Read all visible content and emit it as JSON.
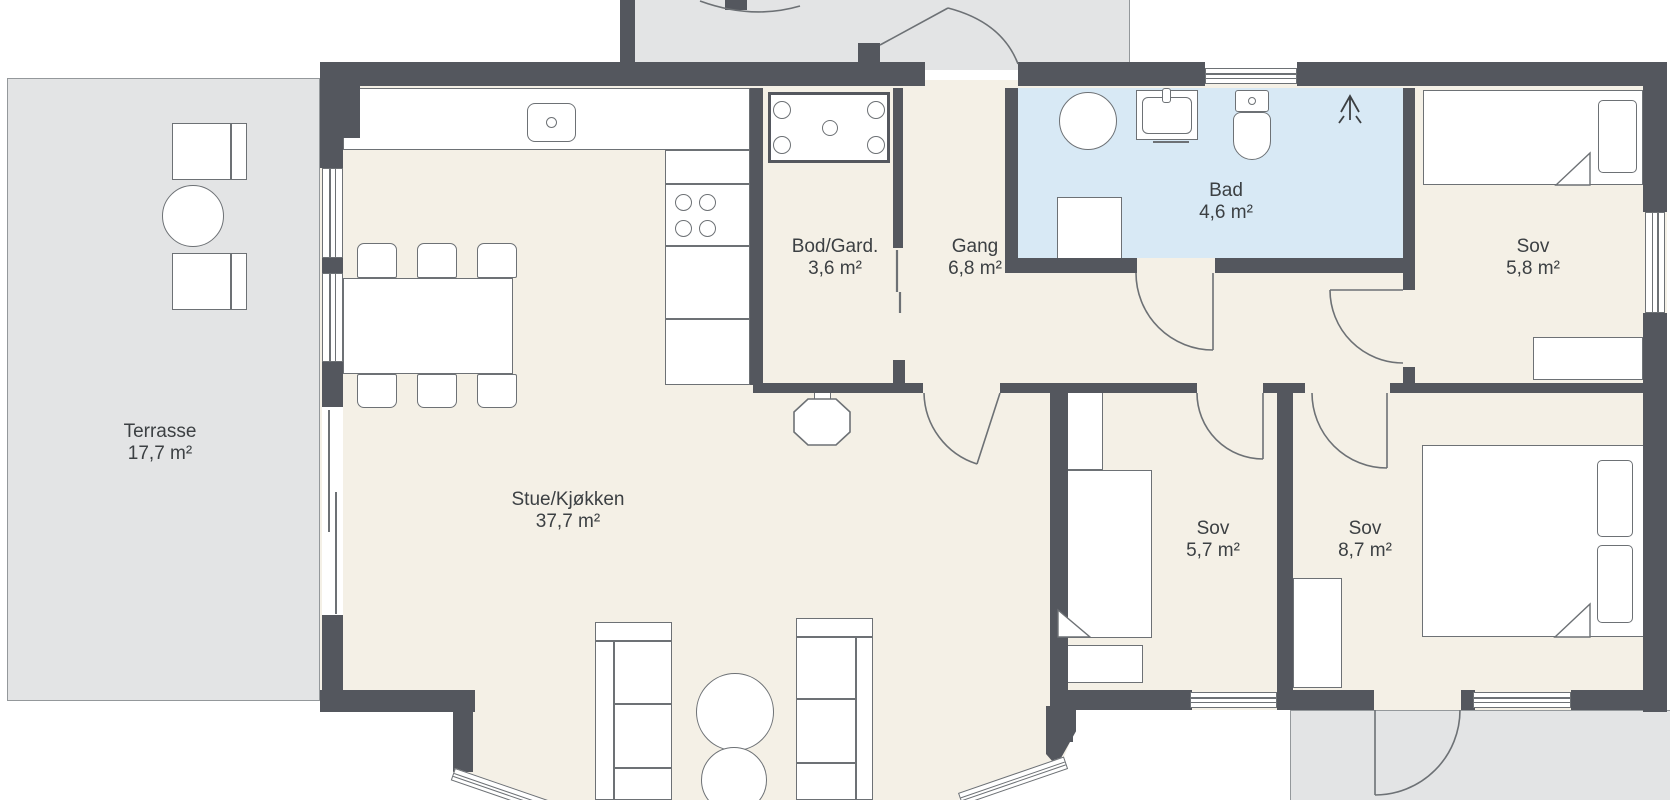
{
  "colors": {
    "background": "#ffffff",
    "wall": "#54575e",
    "floor": "#f4f0e6",
    "bath_floor": "#d8e9f5",
    "outdoor": "#e3e4e5",
    "outdoor_border": "#94989b",
    "outline": "#6d7175",
    "text": "#3c4043"
  },
  "floor_plan": {
    "rooms": [
      {
        "id": "terrasse",
        "name": "Terrasse",
        "area": "17,7 m²",
        "label_x": 160,
        "label_y": 421
      },
      {
        "id": "stue-kjokken",
        "name": "Stue/Kjøkken",
        "area": "37,7 m²",
        "label_x": 568,
        "label_y": 489
      },
      {
        "id": "bod-gard",
        "name": "Bod/Gard.",
        "area": "3,6 m²",
        "label_x": 835,
        "label_y": 236
      },
      {
        "id": "gang",
        "name": "Gang",
        "area": "6,8 m²",
        "label_x": 975,
        "label_y": 236
      },
      {
        "id": "bad",
        "name": "Bad",
        "area": "4,6 m²",
        "label_x": 1226,
        "label_y": 180
      },
      {
        "id": "sov-1",
        "name": "Sov",
        "area": "5,8 m²",
        "label_x": 1533,
        "label_y": 236
      },
      {
        "id": "sov-2",
        "name": "Sov",
        "area": "5,7 m²",
        "label_x": 1213,
        "label_y": 518
      },
      {
        "id": "sov-3",
        "name": "Sov",
        "area": "8,7 m²",
        "label_x": 1365,
        "label_y": 518
      }
    ]
  }
}
